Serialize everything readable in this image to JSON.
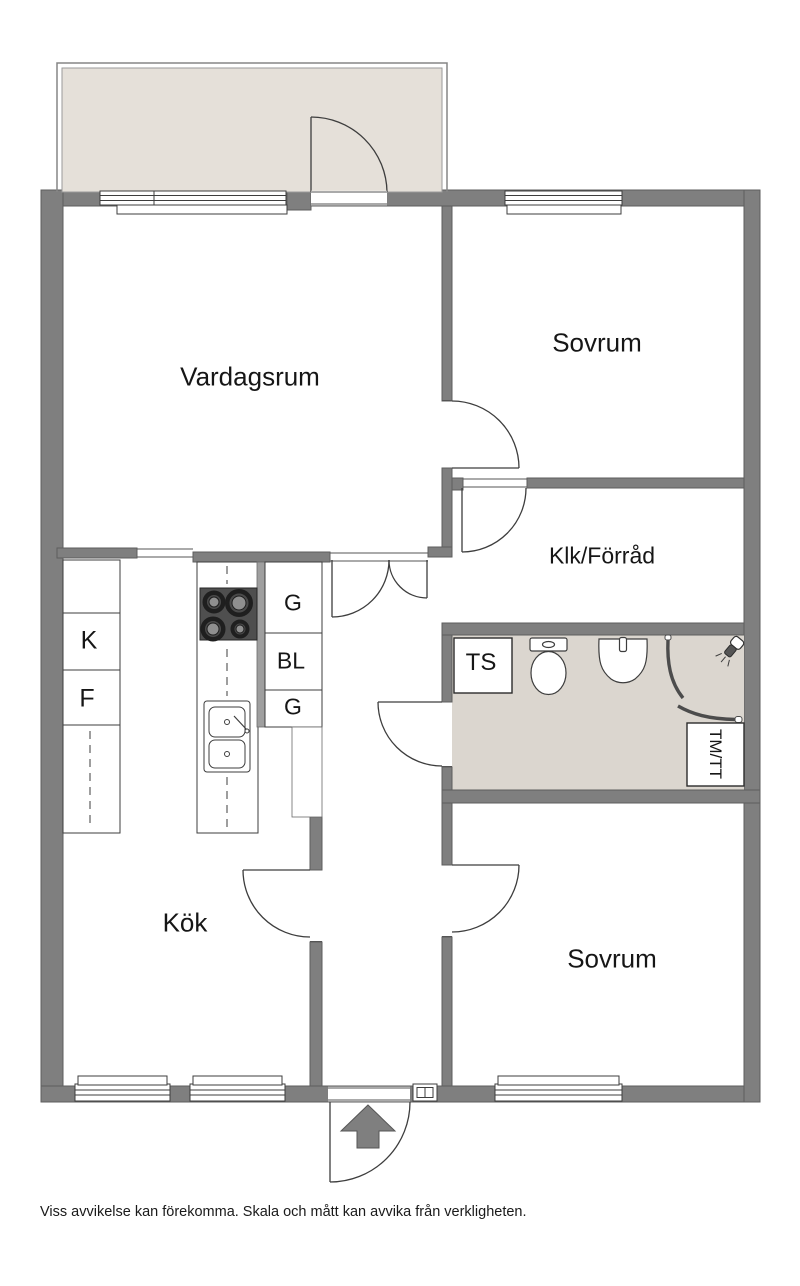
{
  "plan": {
    "title": "Apartment floor plan"
  },
  "rooms": {
    "vardagsrum": "Vardagsrum",
    "sovrum_1": "Sovrum",
    "klk_forrad": "Klk/Förråd",
    "kok": "Kök",
    "sovrum_2": "Sovrum"
  },
  "labels": {
    "k": "K",
    "f": "F",
    "g_upper": "G",
    "bl": "BL",
    "g_lower": "G",
    "ts": "TS",
    "tm_tt": "TM/TT"
  },
  "footer": {
    "disclaimer": "Viss avvikelse kan förekomma. Skala och mått kan avvika från verkligheten."
  },
  "colors": {
    "wall": "#7f7f7f",
    "wall_edge": "#5e5e5e",
    "balcony_floor": "#e5e0d9",
    "bathroom_floor": "#dbd6cf",
    "line": "#3d3d3d"
  }
}
